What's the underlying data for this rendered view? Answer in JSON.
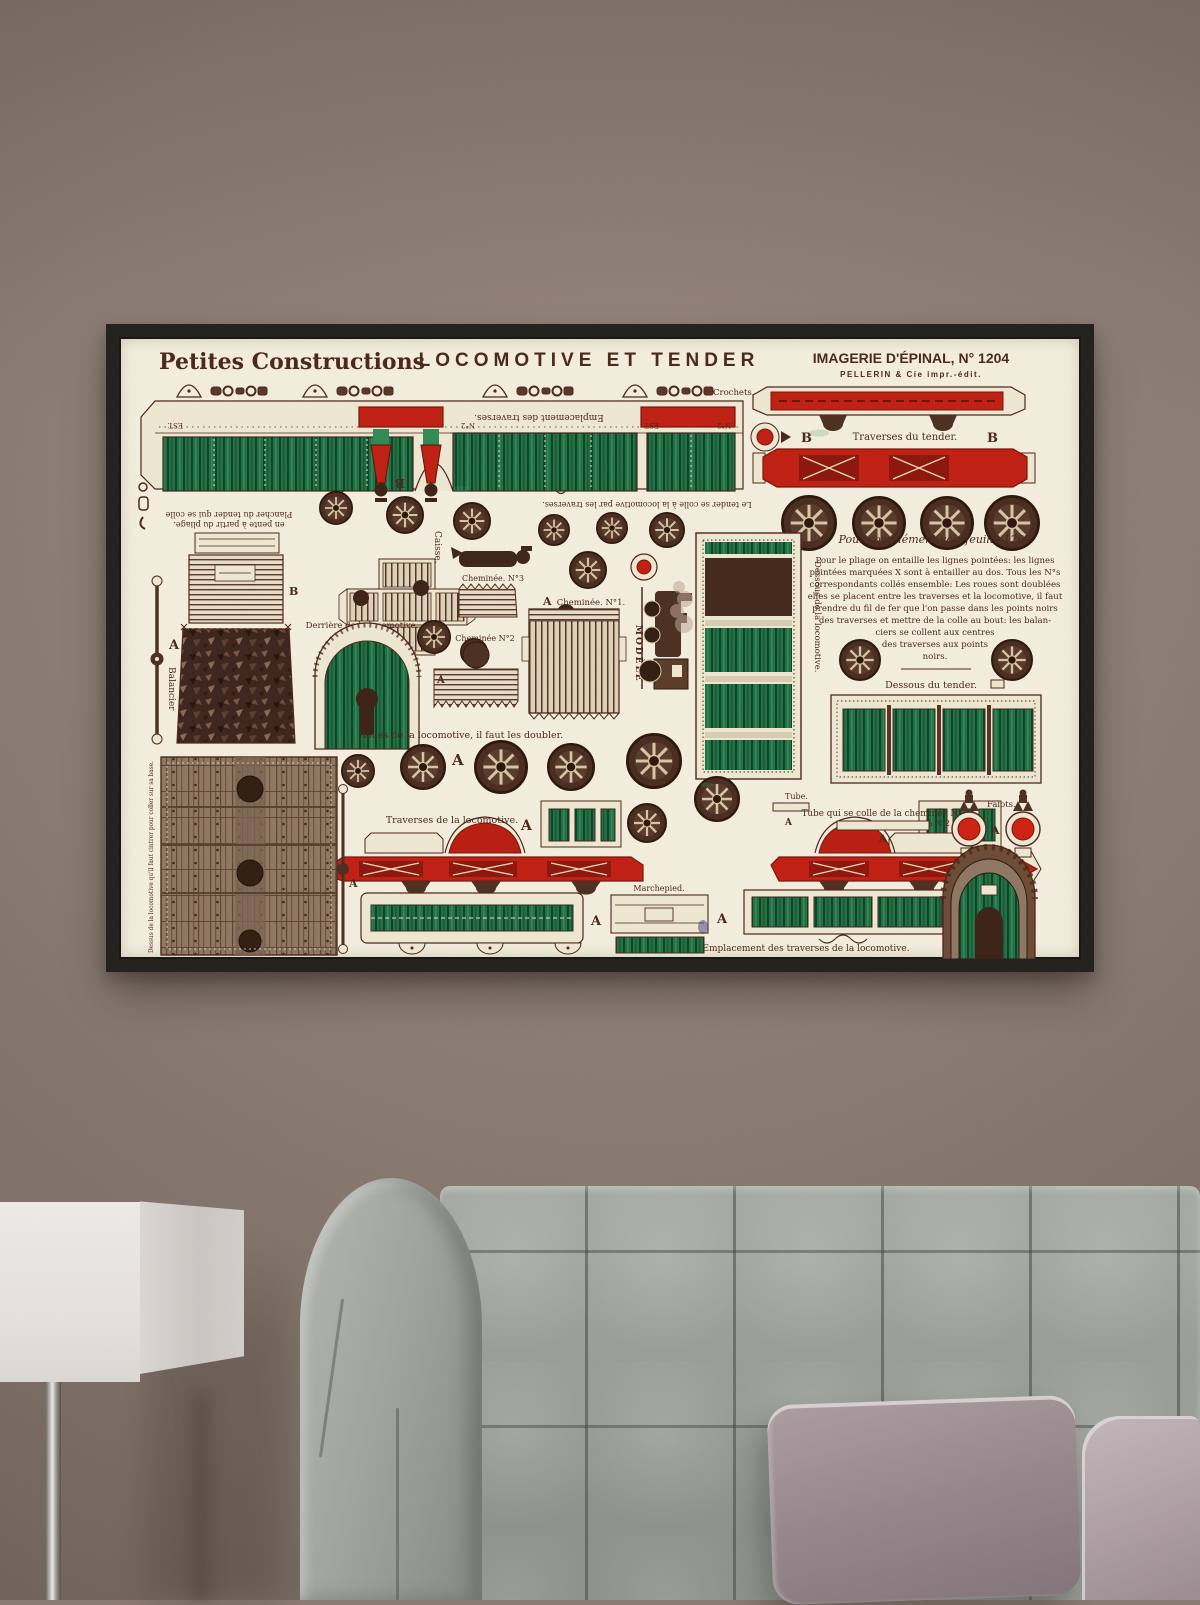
{
  "scene": {
    "wall_color": "#8a7b72",
    "frame_color": "#1f1e1b",
    "sofa_color": "#99a099",
    "pillow_color": "#96878c",
    "side_pillow_color": "#c4b7bb",
    "lamp_color": "#eeece8"
  },
  "poster": {
    "paper_color": "#f4efde",
    "ink_color": "#4a2418",
    "green_color": "#1e6f42",
    "red_color": "#c01d10",
    "header": {
      "series": "Petites Constructions",
      "title": "LOCOMOTIVE ET TENDER",
      "publisher": "IMAGERIE D'ÉPINAL, N° 1204",
      "publisher_sub": "PELLERIN & Cie impr.-édit."
    },
    "letters": {
      "a": "A",
      "b": "B"
    },
    "labels": {
      "crochets": "Crochets.",
      "emplacement_traverses": "Emplacement des traverses.",
      "est": "EST.",
      "n2": "N°2",
      "tender_colle": "Le tender se colle à la locomotive par les traverses.",
      "plancher_1": "Plancher du tender qui se colle",
      "plancher_2": "en pente à partir du pliage.",
      "traverses_tender": "Traverses du tender.",
      "complement": "Pour complément voir feuille 1205",
      "balancier": "Balancier",
      "caisse": "Caisse.",
      "derriere": "Derrière de la locomotive.",
      "cheminee_3": "Cheminée. N°3",
      "cheminee_2": "Cheminée N°2",
      "cheminee_1": "Cheminée. N°1.",
      "modele": "MODÈLE",
      "dessous_loco": "Dessous de la locomotive.",
      "dessous_tender": "Dessous du tender.",
      "roues": "Roues de la locomotive, il faut les doubler.",
      "dessus_loco": "Dessus de la locomotive qu'il faut cintrer pour coller sur sa base.",
      "traverses_loco": "Traverses de la locomotive.",
      "tube": "Tube.",
      "tube_colle_1": "Tube qui se colle de la cheminée N 3",
      "tube_colle_2": "à N 2",
      "falots": "Falots.",
      "marchepied": "Marchepied.",
      "emplacement_loco": "Emplacement des traverses de la locomotive."
    },
    "instructions": [
      "Pour le pliage on entaille les lignes pointées: les lignes",
      "pointées marquées X sont à entailler au dos. Tous les N°s",
      "correspondants collés ensemble: Les roues sont doublées",
      "elles se placent entre les traverses et la locomotive, il faut",
      "prendre du fil de fer que l'on passe dans les points noirs",
      "des traverses et mettre de la colle au bout: les balan-",
      "ciers se collent aux centres",
      "des traverses aux points",
      "noirs."
    ]
  }
}
